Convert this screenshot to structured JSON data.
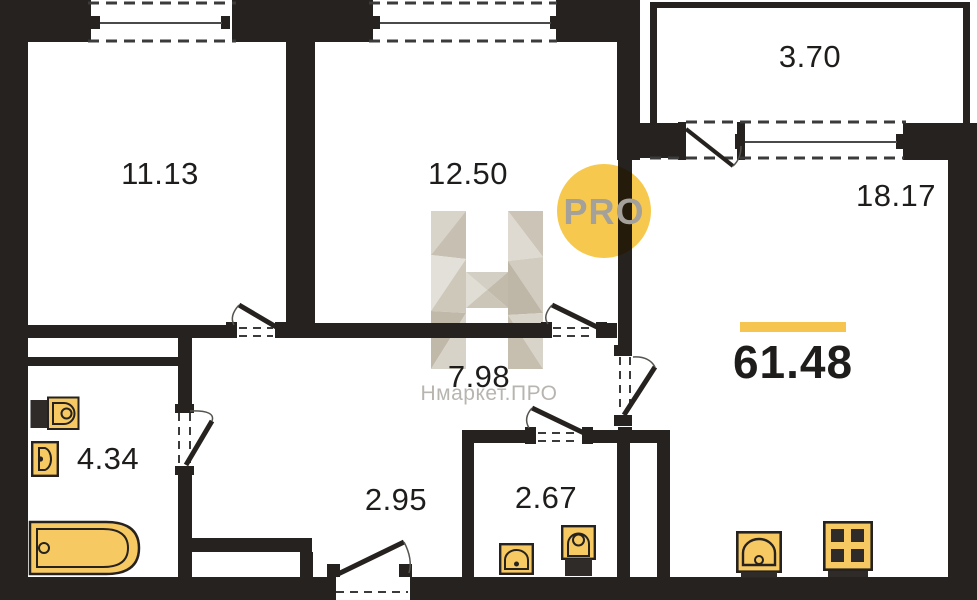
{
  "plan": {
    "total_area": "61.48",
    "rooms": {
      "room1": {
        "label": "11.13"
      },
      "room2": {
        "label": "12.50"
      },
      "balcony": {
        "label": "3.70"
      },
      "living": {
        "label": "18.17"
      },
      "corridor": {
        "label": "7.98"
      },
      "bathroom": {
        "label": "4.34"
      },
      "hall": {
        "label": "2.95"
      },
      "wc": {
        "label": "2.67"
      }
    }
  },
  "watermark": {
    "badge": "PRO",
    "site": "Нмаркет.ПРО"
  },
  "colors": {
    "wall": "#26221f",
    "dash": "#3b3b3b",
    "line": "#4a4a4a",
    "arc": "#56544f",
    "label": "#1f1d1b",
    "accent": "#f5c54f",
    "fixture": "#f7c963",
    "fixture_dark": "#2f2b28",
    "pro_circle": "#f6c94e",
    "pro_text": "#a4a09a",
    "wm_text": "#b8b5b0"
  }
}
